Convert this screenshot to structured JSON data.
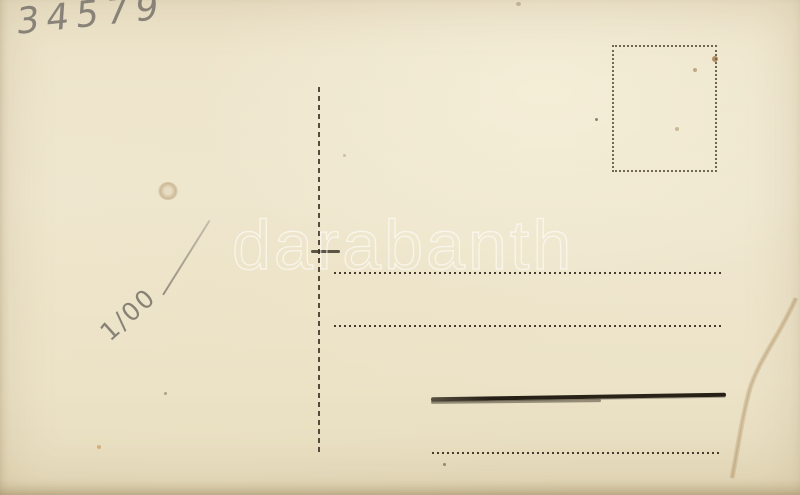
{
  "postcard": {
    "catalog_number": "34579",
    "price_note": "1/00",
    "watermark_text": "darabanth",
    "colors": {
      "paper": "#ece3c9",
      "ink": "#342a1c",
      "pencil": "#8b857a",
      "watermark": "#ffffff"
    }
  }
}
